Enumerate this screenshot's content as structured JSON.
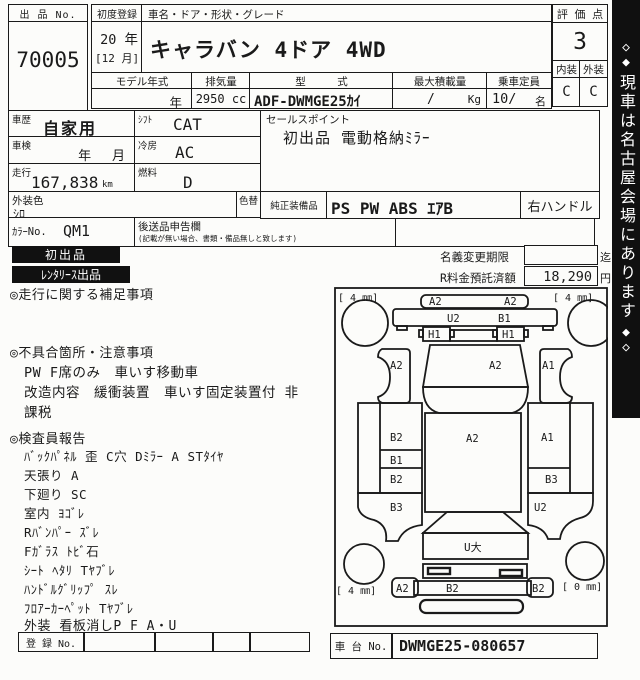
{
  "header": {
    "lot_no_label": "出 品 No.",
    "lot_no": "70005",
    "first_reg_label": "初度登録",
    "first_reg_year": "20 年",
    "first_reg_month": "[12 月]",
    "car_name_label": "車名・ドア・形状・グレード",
    "car_name": "キャラバン 4ドア  4WD",
    "model_year_label": "モデル年式",
    "model_year_value": "年",
    "displacement_label": "排気量",
    "displacement_value": "2950 cc",
    "model_code_label": "型　　　式",
    "model_code_value": "ADF-DWMGE25ｶｲ",
    "max_load_label": "最大積載量",
    "max_load_value": "/",
    "max_load_unit": "Kg",
    "capacity_label": "乗車定員",
    "capacity_value": "10/",
    "capacity_unit": "名",
    "score_label": "評 価 点",
    "score_value": "3",
    "interior_label": "内装",
    "exterior_label": "外装",
    "interior_grade": "C",
    "exterior_grade": "C"
  },
  "details": {
    "history_label": "車歴",
    "history_value": "自家用",
    "shift_label": "ｼﾌﾄ",
    "shift_value": "CAT",
    "inspection_label": "車検",
    "inspection_value": "年　 月",
    "ac_label": "冷房",
    "ac_value": "AC",
    "mileage_label": "走行",
    "mileage_value": "167,838",
    "mileage_unit": "km",
    "fuel_label": "燃料",
    "fuel_value": "D",
    "ext_color_label": "外装色",
    "ext_color_value": "ｼﾛ",
    "color_change_label": "色替",
    "color_no_label": "ｶﾗｰNo.",
    "color_no_value": "QM1",
    "later_goods_label": "後送品申告欄",
    "later_goods_note": "(記載が無い場合、書類・備品無しと致します)",
    "sales_point_label": "セールスポイント",
    "sales_point_value": "初出品  電動格納ﾐﾗｰ",
    "equipment_label": "純正装備品",
    "equipment_value": "PS PW ABS ｴｱB",
    "handle_value": "右ハンドル"
  },
  "badges": {
    "first": "初出品",
    "rental": "ﾚﾝﾀﾘｰｽ出品"
  },
  "fees": {
    "name_change_label": "名義変更期限",
    "name_change_value": "",
    "name_change_unit": "迄",
    "recycle_label": "R料金預託済額",
    "recycle_value": "18,290",
    "recycle_unit": "円"
  },
  "notes": {
    "mileage_note_title": "◎走行に関する補足事項",
    "defects_title": "◎不具合箇所・注意事項",
    "defects_lines": [
      "PW F席のみ　車いす移動車",
      "改造内容　緩衝装置　車いす固定装置付 非",
      "課税"
    ],
    "inspector_title": "◎検査員報告",
    "inspector_lines": [
      "ﾊﾞｯｸﾊﾟﾈﾙ 歪 C穴  Dﾐﾗｰ A  STﾀｲﾔ",
      "天張り A",
      "下廻り SC",
      "室内 ﾖｺﾞﾚ",
      "Rﾊﾞﾝﾊﾟｰ ｽﾞﾚ",
      "Fｶﾞﾗｽ ﾄﾋﾞ石",
      "ｼｰﾄ ﾍﾀﾘ Tﾔﾌﾞﾚ",
      "ﾊﾝﾄﾞﾙｸﾞﾘｯﾌﾟ ｽﾚ",
      "ﾌﾛｱｰｶｰﾍﾟｯﾄ Tﾔﾌﾞﾚ",
      "外装 看板消しP F A・U"
    ]
  },
  "footer": {
    "reg_no_label": "登 録 No.",
    "chassis_label": "車 台 No.",
    "chassis_value": "DWMGE25-080657"
  },
  "sidebar": {
    "diamond_hollow": "◇",
    "diamond_filled": "◆",
    "text": "現車は名古屋会場にあります"
  },
  "diagram": {
    "tire_front_left": "[ 4 ㎜]",
    "tire_front_right": "[ 4 ㎜]",
    "tire_rear_left": "[ 4 ㎜]",
    "tire_rear_right": "[ 0 ㎜]",
    "front_bumper_left": "A2",
    "front_bumper_right": "A2",
    "front_panel_left": "U2",
    "front_panel_right": "B1",
    "headlight_left": "H1",
    "headlight_right": "H1",
    "fender_left": "A2",
    "windshield": "A2",
    "fender_right": "A1",
    "side_left_1": "B2",
    "side_left_2": "B1",
    "side_left_3": "B2",
    "quarter_left": "B3",
    "roof": "A2",
    "side_right_1": "A1",
    "side_right_2": "B3",
    "quarter_right": "U2",
    "tailgate": "U大",
    "rear_bumper_left": "A2",
    "rear_bumper_center": "B2",
    "rear_bumper_right": "B2"
  }
}
